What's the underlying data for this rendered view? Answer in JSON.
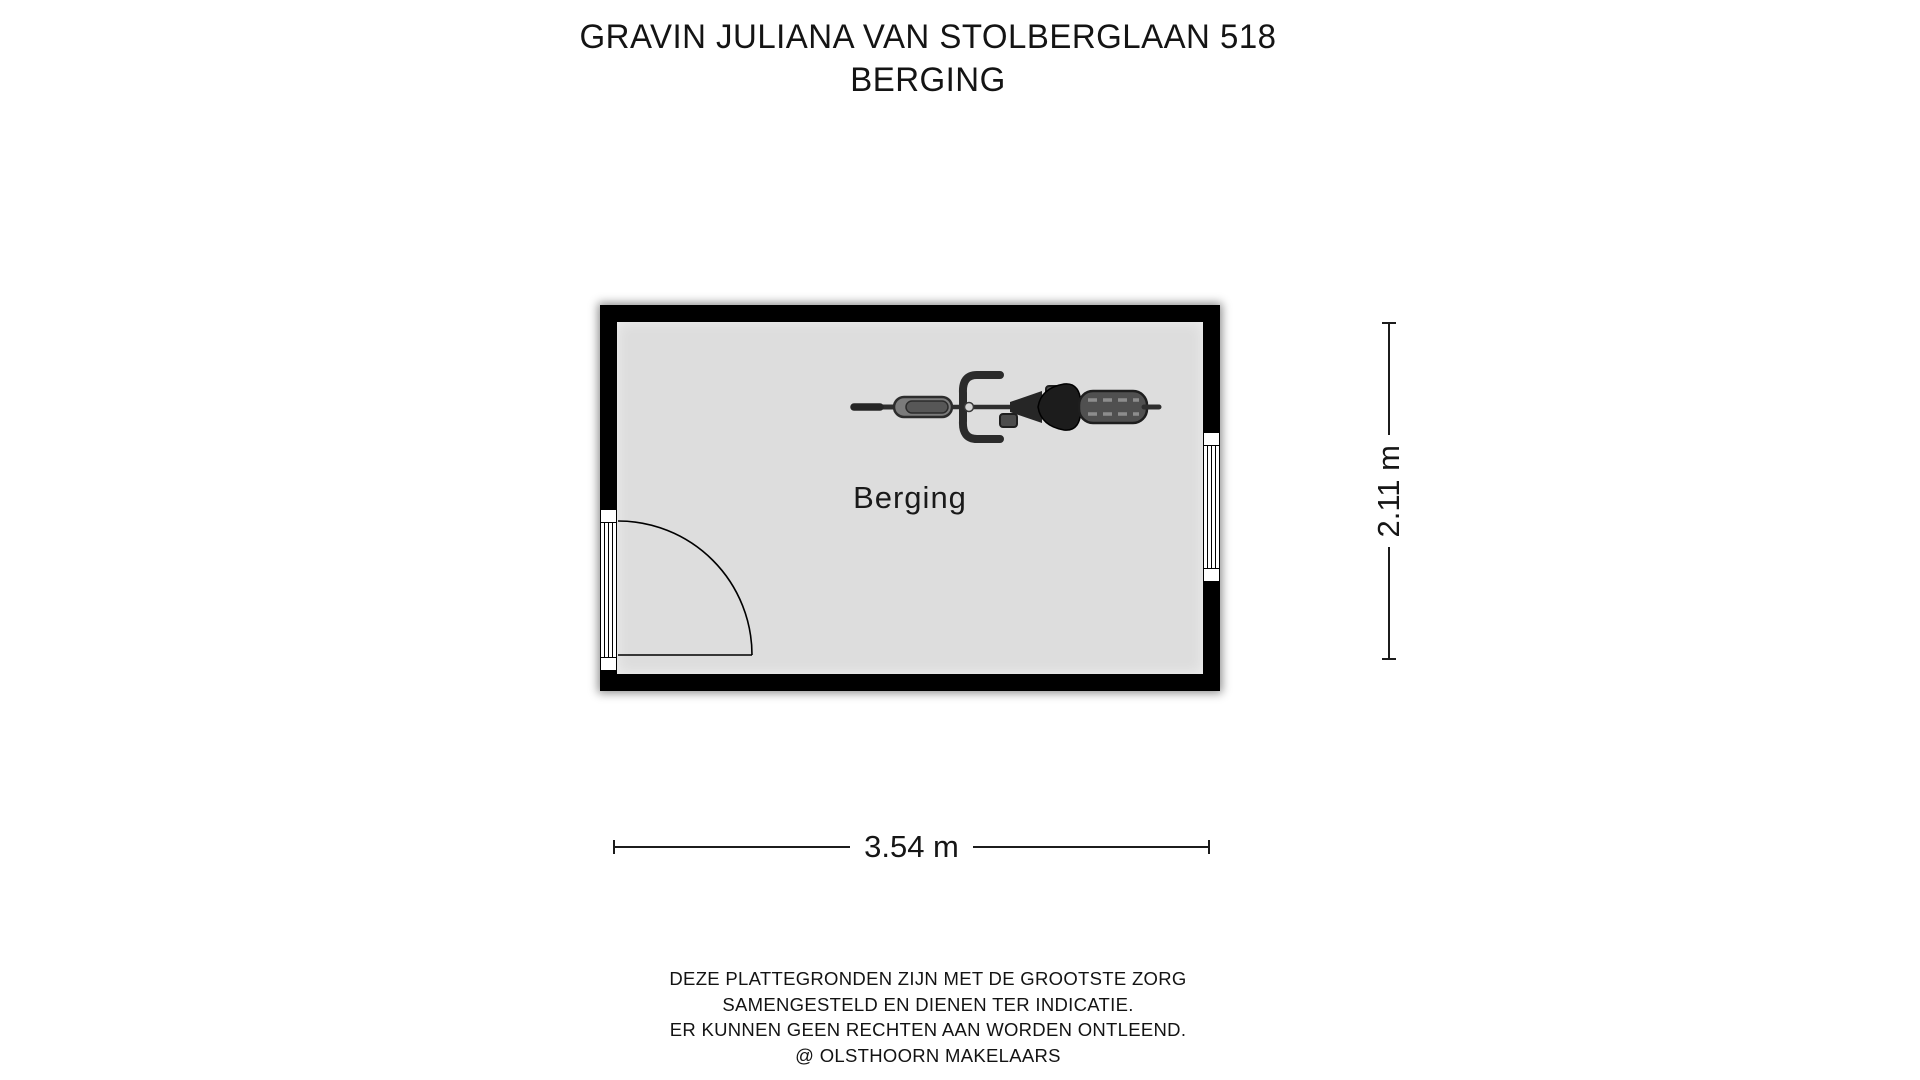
{
  "title": {
    "line1": "GRAVIN JULIANA VAN STOLBERGLAAN 518",
    "line2": "BERGING"
  },
  "floorplan": {
    "room_label": "Berging",
    "dimensions": {
      "width": "3.54 m",
      "height": "2.11 m"
    },
    "icons": [
      "bicycle-icon",
      "door-swing",
      "window"
    ]
  },
  "footer": {
    "lines": [
      "DEZE PLATTEGRONDEN ZIJN MET DE GROOTSTE ZORG",
      "SAMENGESTELD EN DIENEN TER INDICATIE.",
      "ER KUNNEN GEEN RECHTEN AAN WORDEN ONTLEEND.",
      "@ OLSTHOORN MAKELAARS"
    ]
  },
  "colors": {
    "wall": "#000000",
    "floor": "#dddddd",
    "background": "#ffffff",
    "text": "#111111"
  }
}
